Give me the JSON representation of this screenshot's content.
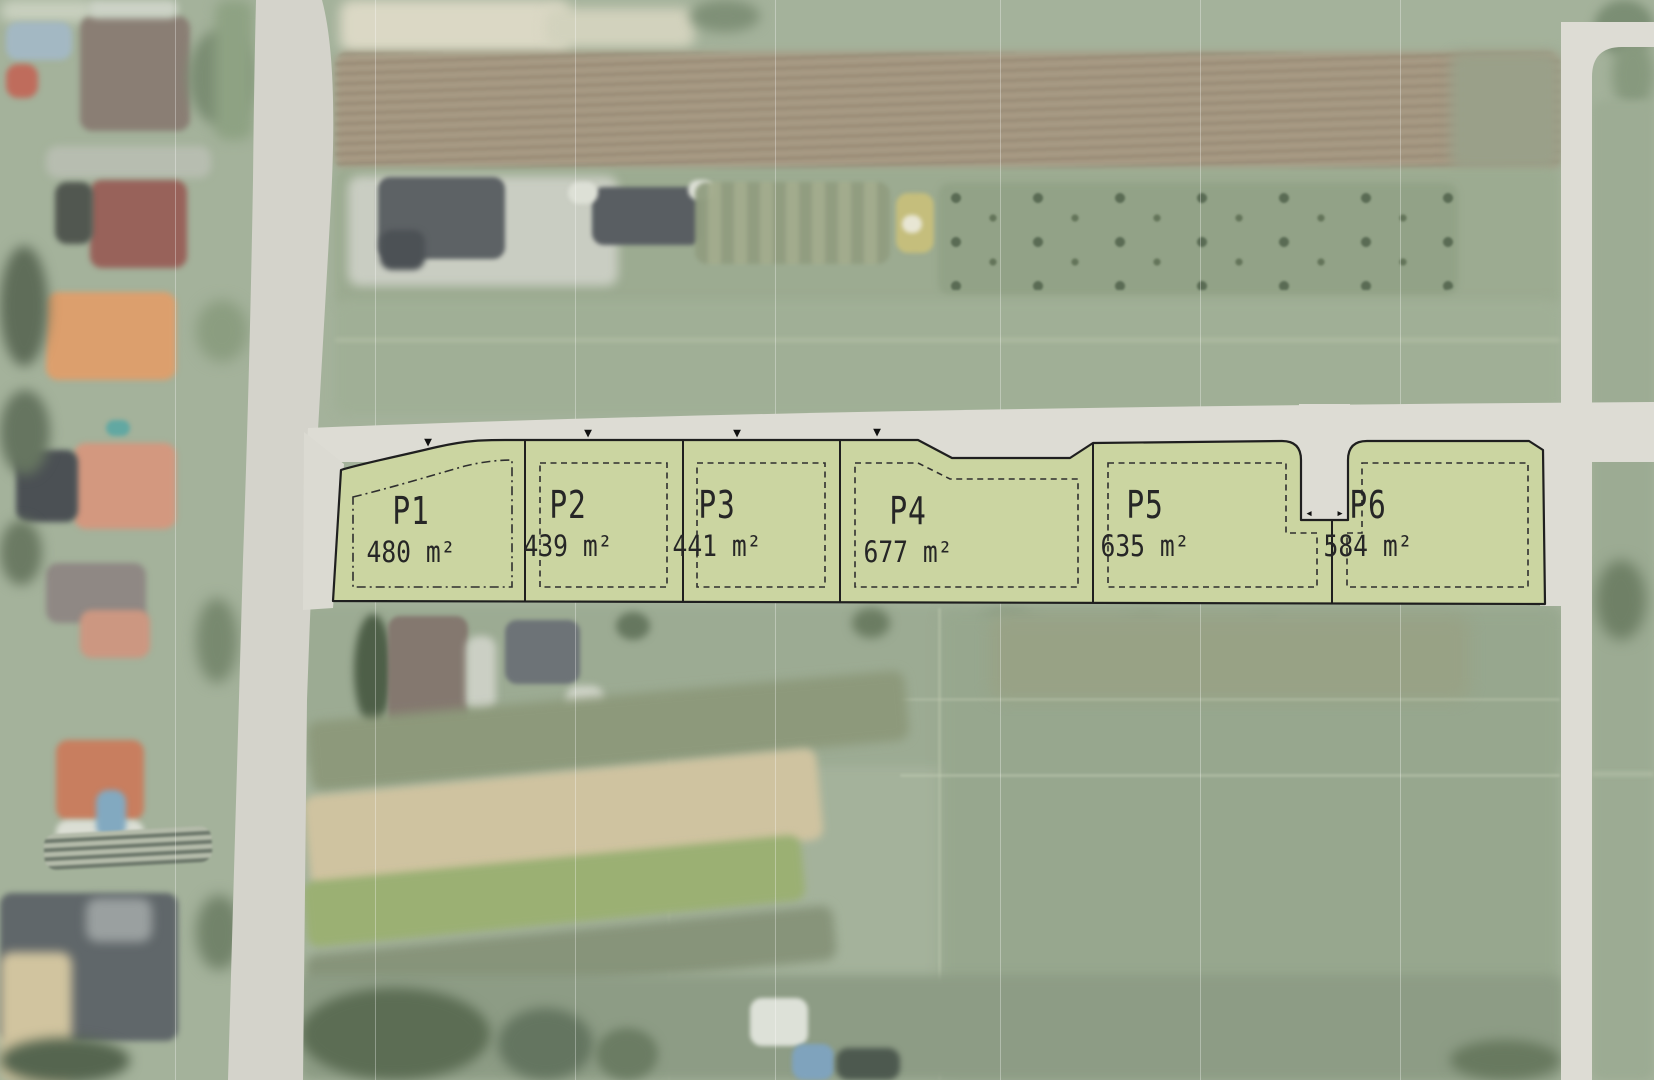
{
  "plots": [
    {
      "id": "P1",
      "area": "480 m²"
    },
    {
      "id": "P2",
      "area": "439 m²"
    },
    {
      "id": "P3",
      "area": "441 m²"
    },
    {
      "id": "P4",
      "area": "677 m²"
    },
    {
      "id": "P5",
      "area": "635 m²"
    },
    {
      "id": "P6",
      "area": "584 m²"
    }
  ],
  "icons": {
    "plot_access_marker": "▼",
    "notch_marker_left": "◂",
    "notch_marker_right": "▸"
  },
  "colors": {
    "plot_fill": "#cbd5a1",
    "plot_outline": "#1f1f1f",
    "setback_line": "#2f2f2f",
    "road": "#dddcd4",
    "road_left": "#d4d3cb",
    "label_text": "#262626"
  }
}
